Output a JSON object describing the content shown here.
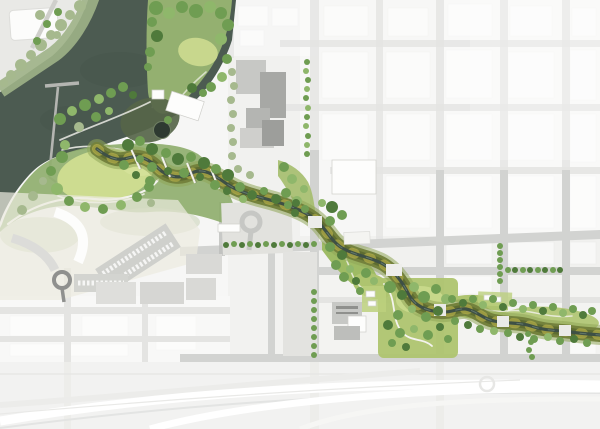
{
  "meta": {
    "kind": "map",
    "subtype": "landscape-masterplan-aerial-render",
    "width_px": 600,
    "height_px": 429,
    "visible_text": "none"
  },
  "palette": {
    "bg": "#f6f6f5",
    "water": "#4c5b51",
    "waterEdge": "#5d6d61",
    "inlet": "#566549",
    "pond": "#2e3a31",
    "shoreMuted": "#9fb387",
    "parkGreen": "#8fae6e",
    "peninsula": "#94b070",
    "treeDark": "#4f7a3b",
    "treeMid": "#6f9d52",
    "treeLight": "#8fb76b",
    "treeMuted": "#a6b98e",
    "treeYellow": "#b9c96a",
    "lawnBright": "#cddc90",
    "lawnMid": "#aec46f",
    "oliveHalo": "#8fa558",
    "olive": "#74823d",
    "oliveDark": "#5a682f",
    "accentYellow": "#c3b94e",
    "creek": "#3e5045",
    "creekLight": "#7b9183",
    "pathWhite": "#f4f3ee",
    "roadFaded": "#e4e4e2",
    "roadLight": "#d2d3d1",
    "roadGray": "#bdbebb",
    "blockBase": "#f1f1ef",
    "blockTexture": "#ffffff",
    "buildingGray": "#c7c8c5",
    "buildingDark": "#a7a8a5",
    "plaza": "#e2e2de",
    "parking": "#cfd0cc",
    "fieldTan": "#edebdf",
    "highwayBase": "#f2f2f1",
    "rampWhite": "#ffffff",
    "rampShadow": "#e3e4e3",
    "pier": "#b4b5b1",
    "white": "#fdfdfc"
  },
  "features": {
    "lake": "lake",
    "pier": "pier",
    "dock": "dock-piles",
    "peninsula": "peninsula-park",
    "pond": "pond",
    "inlet": "wet-meadow-inlet",
    "meadow": "meadow-lawn",
    "creek": "creek-corridor",
    "bridges": "pedestrian-bridges",
    "arcBuilding": "arc-building",
    "parking": "parking-lots",
    "dropOff": "drop-off-loop",
    "roundabout": "roundabout",
    "plaza": "plaza",
    "cityGrid": "city-street-grid",
    "streetTrees": "street-trees",
    "neighborhoodPark": "neighborhood-park",
    "greenway": "east-greenway",
    "highway": "highway-interchange"
  }
}
